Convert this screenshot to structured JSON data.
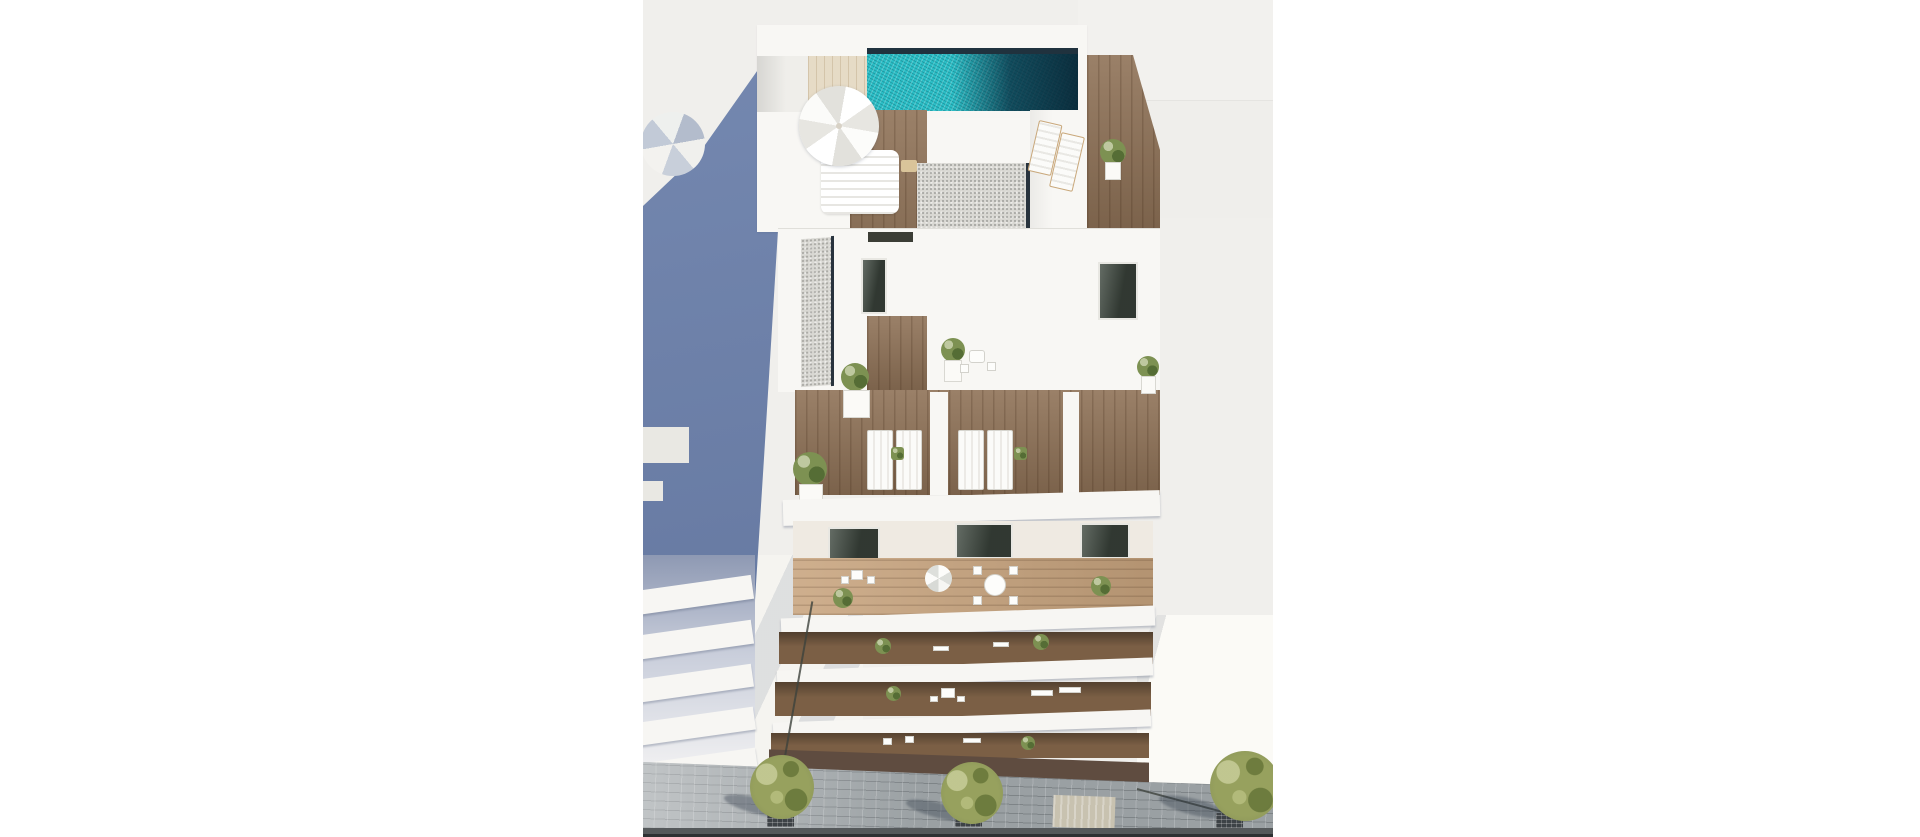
{
  "scene": {
    "type": "architectural-3d-aerial-render",
    "subject": "New-build residential apartment block seen from above, with rooftop infinity pool, solarium terraces with parasols and sun loungers, gravel roof sections, stacked balconies with plants and outdoor furniture, neighbouring white building casting area in shade, and a paved street with young trees below",
    "elements": [
      "rooftop-pool",
      "pool-deck",
      "main-parasol",
      "shaded-parasol",
      "daybed",
      "sun-loungers",
      "gravel-roofs",
      "terrace-planters",
      "terrace-table-set",
      "balcony-rows",
      "glass-doors",
      "street-pavement",
      "street-trees",
      "tree-grates",
      "lamp-posts",
      "cast-shadow",
      "neighbour-balcony-slabs"
    ]
  },
  "palette": {
    "page_bg": "#ffffff",
    "photo_bg": "#f0efec",
    "bg_panel_a": "#f2f1ee",
    "bg_panel_b": "#efeeeb",
    "shadow_blue": "#6b80ab",
    "neighbor_gap": "#aab3c6",
    "slab_white": "#f7f6f3",
    "white_wall": "#f8f7f4",
    "pool_teal": "#2bbec6",
    "pool_edge_dark": "#20323e",
    "beige_deck": "#e6dbc6",
    "wood_deck": "#8f7257",
    "wood_balcony": "#7b5f45",
    "wood_light": "#c8a47e",
    "gravel": "#d9d8d3",
    "gravel_edge": "#28333d",
    "glass_dark": "#414b42",
    "foliage_green": "#7d9152",
    "tree_olive": "#97a15e",
    "pavement": "#9aa0a3",
    "tactile": "#c8c2b0",
    "kerb": "#55595b",
    "road_dark": "#2e3133",
    "under_shadow": "#5f4c40",
    "sun_ground": "#fbfaf6",
    "left_ground": "#f5f4f0",
    "lamp": "#3d423c",
    "grate": "#3d4246"
  }
}
